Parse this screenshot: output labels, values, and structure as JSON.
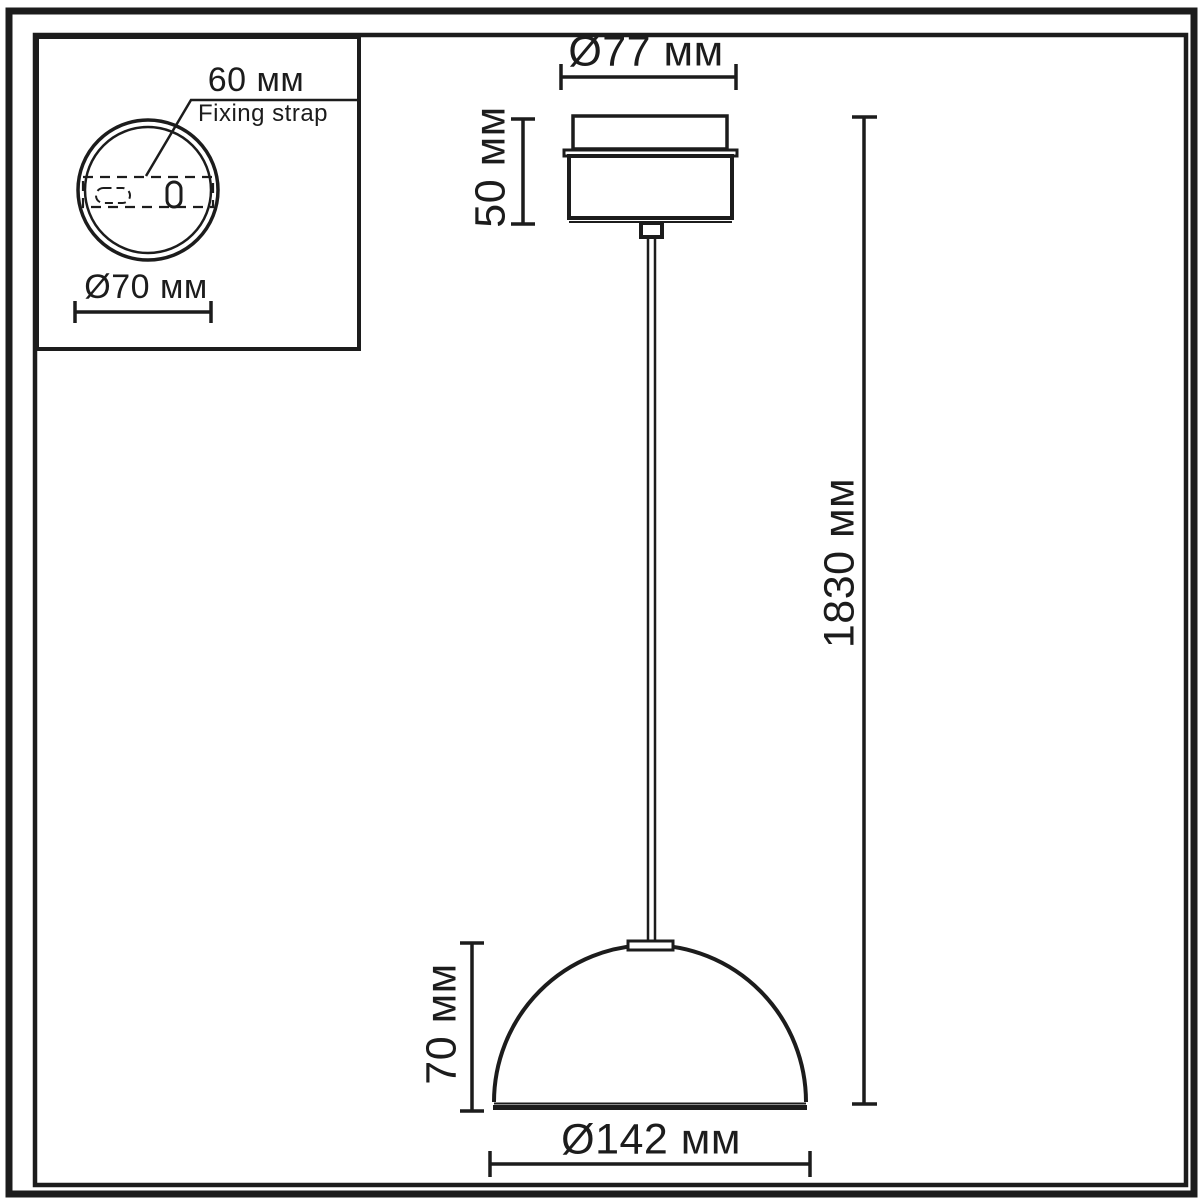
{
  "colors": {
    "line": "#1c1c1c",
    "background": "#ffffff"
  },
  "inset_top_view": {
    "strap_width": "60 мм",
    "strap_name": "Fixing strap",
    "base_diameter": "Ø70 мм"
  },
  "main_view": {
    "canopy_diameter": "Ø77 мм",
    "canopy_height": "50 мм",
    "overall_height": "1830 мм",
    "shade_height": "70 мм",
    "shade_diameter": "Ø142 мм"
  }
}
